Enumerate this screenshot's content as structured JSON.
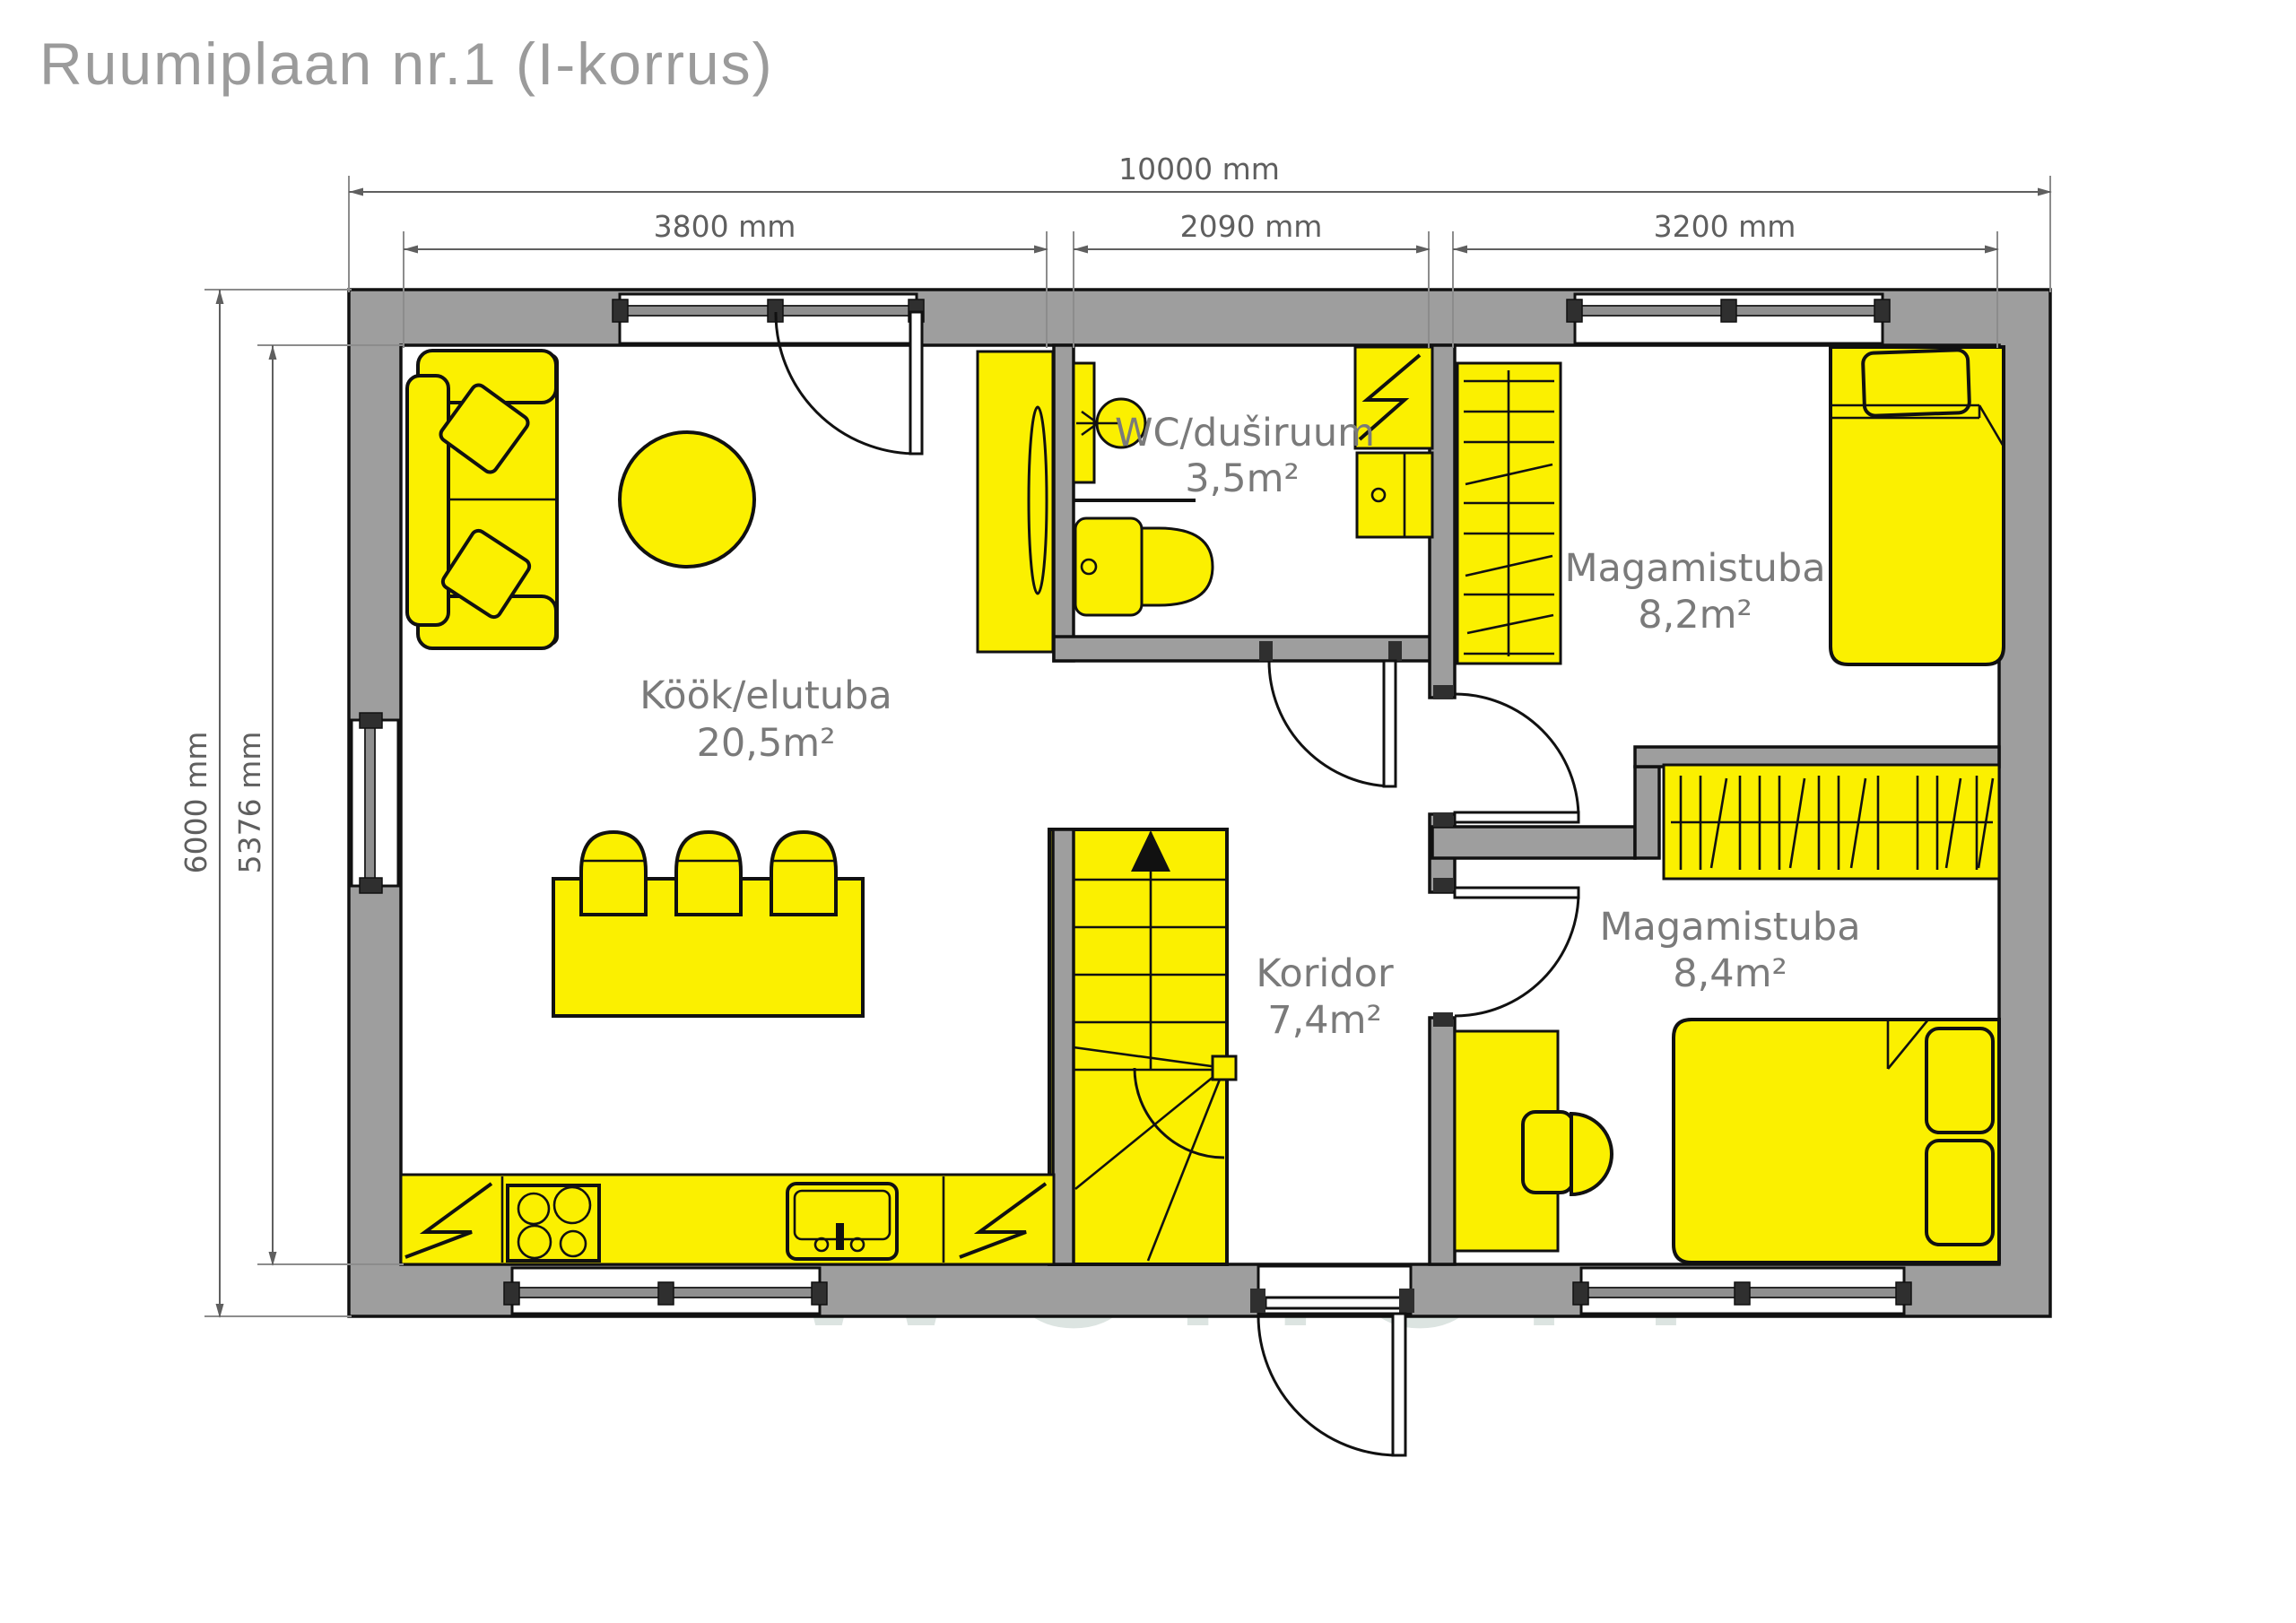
{
  "title": "Ruumiplaan nr.1 (I-korrus)",
  "watermark": {
    "wordmark": "WOHOM"
  },
  "dimensions": {
    "total_width": "10000 mm",
    "living_width": "3800 mm",
    "wc_width": "2090 mm",
    "bedroom_width": "3200 mm",
    "total_height": "6000 mm",
    "interior_height": "5376 mm"
  },
  "rooms": {
    "living": {
      "name": "Köök/elutuba",
      "area": "20,5m²"
    },
    "bathroom": {
      "name": "WC/duširuum",
      "area": "3,5m²"
    },
    "bedroom1": {
      "name": "Magamistuba",
      "area": "8,2m²"
    },
    "corridor": {
      "name": "Koridor",
      "area": "7,4m²"
    },
    "bedroom2": {
      "name": "Magamistuba",
      "area": "8,4m²"
    }
  },
  "colors": {
    "wall": "#9e9e9e",
    "yellow": "#FBF000",
    "label": "#7a7a7a",
    "dim": "#5f5f5f",
    "title": "#9b9b9b",
    "wm": "#dce4e1"
  }
}
